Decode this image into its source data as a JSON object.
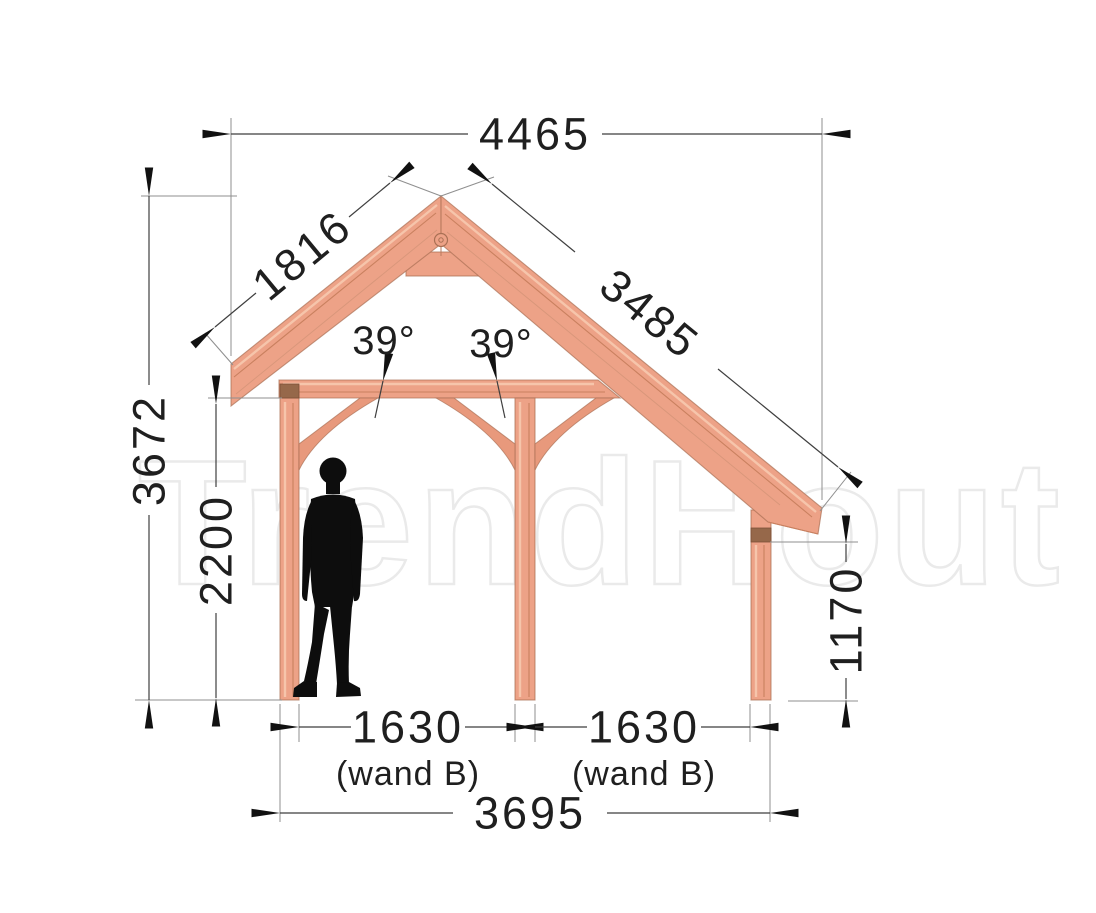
{
  "watermark": {
    "text": "TrendHout"
  },
  "dims": {
    "top_width": "4465",
    "rafter_left_length": "1816",
    "rafter_right_length": "3485",
    "angle_left": "39°",
    "angle_right": "39°",
    "height_total": "3672",
    "height_clearance": "2200",
    "height_right_post": "1170",
    "bay_left_width": "1630",
    "bay_left_note": "(wand B)",
    "bay_right_width": "1630",
    "bay_right_note": "(wand B)",
    "base_width": "3695"
  },
  "colors": {
    "wood_main": "#eda287",
    "wood_light": "#f6c5ab",
    "wood_dark": "#c9805f",
    "end_grain_band": "#96684a",
    "dimension_line": "#3f3f3f",
    "extension_line": "#8f8f8f",
    "text": "#1f1f1f",
    "silhouette": "#0d0d0d",
    "watermark_outline": "#eaeaea",
    "background": "#ffffff"
  }
}
